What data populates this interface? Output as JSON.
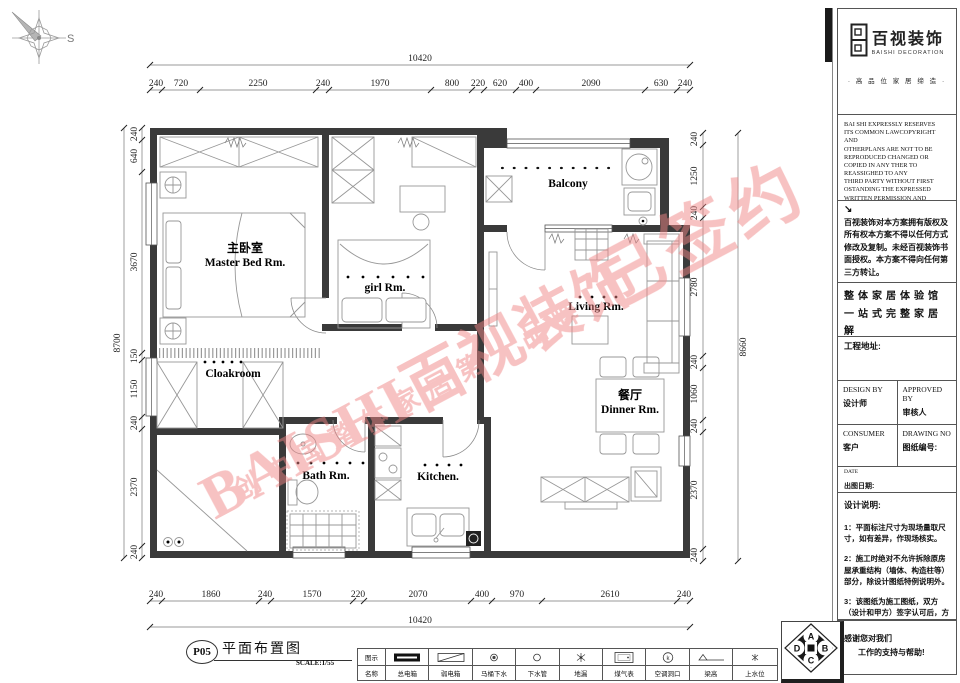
{
  "compass": {
    "label": "S"
  },
  "dims": {
    "top_total": "10420",
    "top_segments": [
      "240",
      "720",
      "2250",
      "240",
      "1970",
      "800",
      "220",
      "620",
      "400",
      "2090",
      "630",
      "240"
    ],
    "bottom_total": "10420",
    "bottom_segments": [
      "240",
      "1860",
      "240",
      "1570",
      "220",
      "2070",
      "400",
      "970",
      "2610",
      "240"
    ],
    "left_total": "8700",
    "left_segments": [
      "240",
      "640",
      "3670",
      "150",
      "1150",
      "240",
      "2370",
      "240"
    ],
    "right_total": "8660",
    "right_segments": [
      "240",
      "1250",
      "240",
      "2780",
      "240",
      "1060",
      "240",
      "2370",
      "240"
    ]
  },
  "rooms": {
    "master_zh": "主卧室",
    "master_en": "Master Bed Rm.",
    "girl_en": "girl  Rm.",
    "balcony_en": "Balcony",
    "living_en": "Living Rm.",
    "cloakroom_en": "Cloakroom",
    "dinner_zh": "餐厅",
    "dinner_en": "Dinner Rm.",
    "bath_en": "Bath  Rm.",
    "kitchen_en": "Kitchen."
  },
  "watermark": {
    "main": "BAISHI百视装饰",
    "stamp": "已签约",
    "sub": "创中国整体家居第一品牌",
    "color": "#ef8585"
  },
  "panel": {
    "logo_zh": "百视装饰",
    "logo_en": "BAISHI DECORATION",
    "tagline": "· 高 品 位 家 居 缔 造 ·",
    "copyright_en": "BAI SHI EXPRESSLY RESERVES\nITS COMMON LAWCOPYRIGHT AND\nOTHERPLANS ARE NOT TO BE\nREPRODUCED CHANGED OR\nCOPIED IN ANY THER TO\nREASSIGHED TO ANY\nTHIRD PARTY WITHOUT FIRST\nOSTANDING THE EXPRESSED\nWRITTEN PERMISSION AND\nCONSENT OF BAI SHI\nDECORATION",
    "arrow": "↘",
    "copyright_zh": "百视装饰对本方案拥有版权及所有权本方案不得以任何方式修改及复制。未经百视装饰书面授权。本方案不得向任何第三方转让。",
    "slogan": "整体家居体验馆\n一站式完整家居解\n决方案",
    "address_label": "工程地址:",
    "design_by_en": "DESIGN BY",
    "design_by_zh": "设计师",
    "approved_by_en": "APPROVED BY",
    "approved_by_zh": "审核人",
    "consumer_en": "CONSUMER",
    "consumer_zh": "客户",
    "drawing_no_en": "DRAWING NO",
    "drawing_no_zh": "图纸编号:",
    "date_en": "DATE",
    "date_zh": "出图日期:",
    "notes_title": "设计说明:",
    "notes": [
      "1：平面标注尺寸为现场量取尺寸，如有差异，作现场核实。",
      "2：施工时绝对不允许拆除原房屋承重结构（墙体、构造柱等）部分，除设计图纸特例说明外。",
      "3：该图纸为施工图纸，双方（设计和甲方）签字认可后，方可作为施工依据。"
    ],
    "thanks_line1": "感谢您对我们",
    "thanks_line2": "工作的支持与帮助!"
  },
  "footer": {
    "sheet_no": "P05",
    "sheet_title": "平面布置图",
    "scale": "SCALE:1/55",
    "legend": {
      "col_icon": "图示",
      "col_name": "名称",
      "ac_char": "k",
      "items": [
        {
          "name": "总电箱"
        },
        {
          "name": "弱电箱"
        },
        {
          "name": "马桶下水"
        },
        {
          "name": "下水管"
        },
        {
          "name": "地漏"
        },
        {
          "name": "煤气表"
        },
        {
          "name": "空调洞口"
        },
        {
          "name": "梁高"
        },
        {
          "name": "上水位"
        }
      ]
    }
  },
  "stamp_mark": {
    "letters": [
      "A",
      "B",
      "C",
      "D"
    ]
  }
}
